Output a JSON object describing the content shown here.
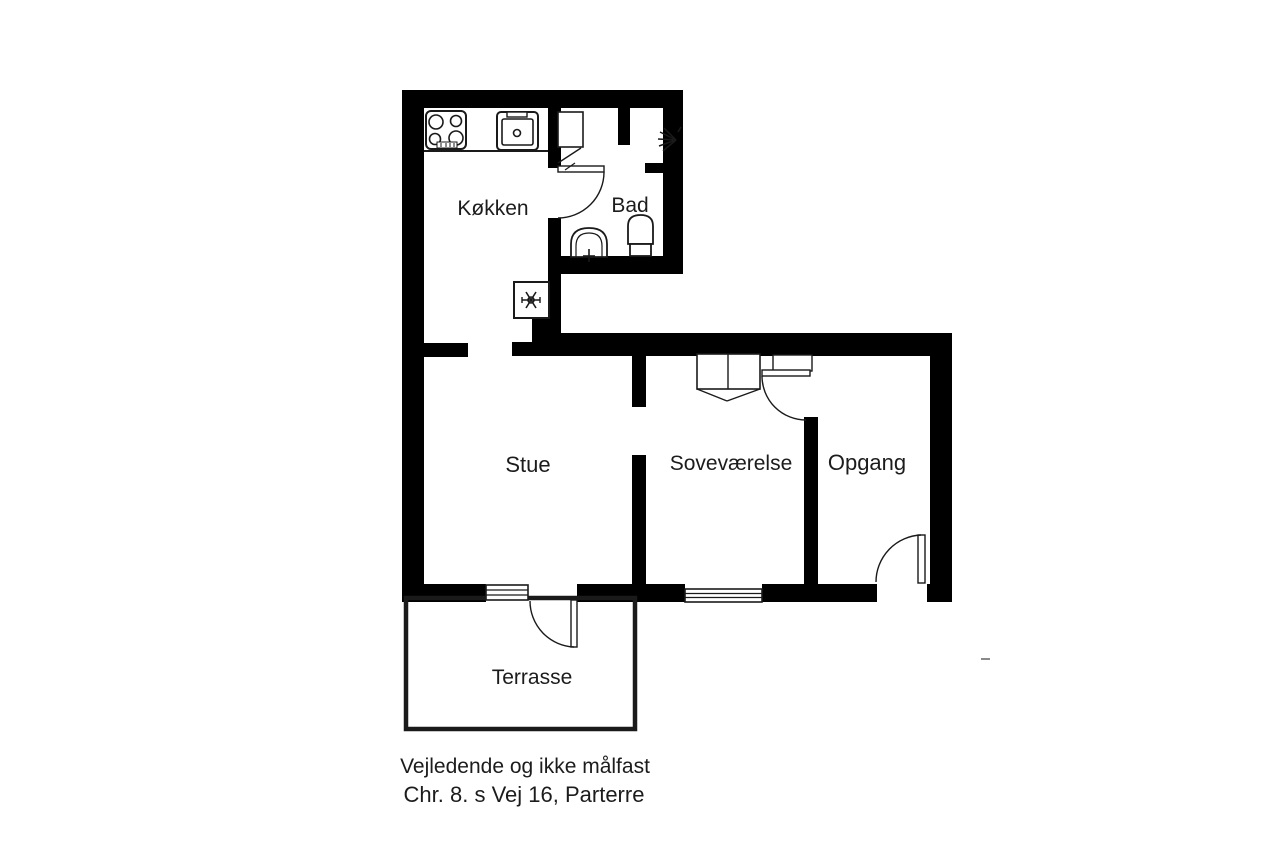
{
  "plan": {
    "title": "Floor plan",
    "rooms": {
      "kokken": "Køkken",
      "bad": "Bad",
      "stue": "Stue",
      "sovevaerelse": "Soveværelse",
      "opgang": "Opgang",
      "terrasse": "Terrasse"
    },
    "footer": {
      "line1": "Vejledende og ikke målfast",
      "line2": "Chr. 8. s Vej 16, Parterre"
    },
    "icons": {
      "stove": "stove-icon",
      "kitchen_sink": "kitchen-sink-icon",
      "boiler": "boiler-fan-icon",
      "shower": "shower-head-icon",
      "bath_sink": "bath-sink-icon",
      "toilet": "toilet-icon",
      "wardrobe": "wardrobe-icon"
    },
    "colors": {
      "wall": "#000000",
      "line": "#1a1a1a",
      "text": "#1c1c1c",
      "background": "#ffffff",
      "stray_mark": "#8a8a8a"
    }
  }
}
